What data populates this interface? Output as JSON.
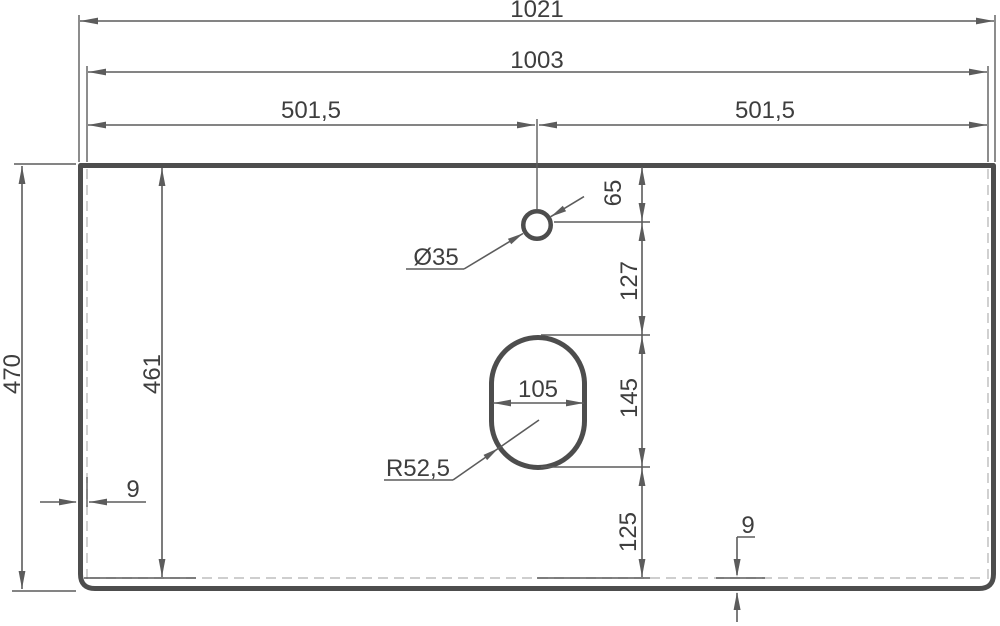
{
  "drawing": {
    "dims": {
      "overall_width": "1021",
      "inner_width": "1003",
      "left_half": "501,5",
      "right_half": "501,5",
      "overall_depth": "470",
      "inner_depth": "461",
      "left_edge_thickness": "9",
      "bottom_edge_thickness": "9",
      "hole_top_offset": "65",
      "hole_to_cutout": "127",
      "cutout_length": "145",
      "cutout_bottom_offset": "125",
      "cutout_width": "105",
      "hole_diameter": "Ø35",
      "cutout_corner_radius": "R52,5"
    },
    "colors": {
      "line": "#4d4d4d",
      "dim": "#5c5c5c",
      "text": "#3e3e3e",
      "hidden": "#bdbdbd",
      "background": "#ffffff"
    }
  }
}
